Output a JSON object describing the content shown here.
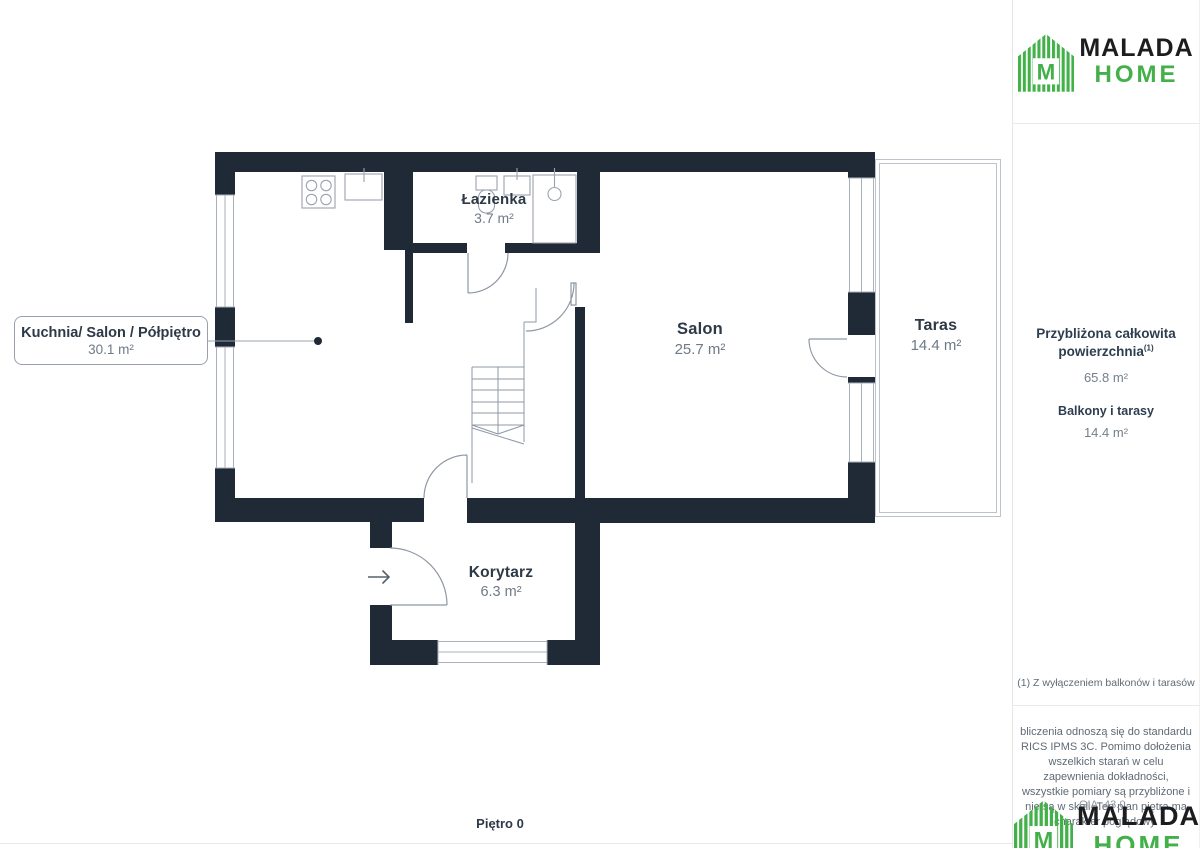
{
  "brand": {
    "primary": "MALADA",
    "secondary": "HOME"
  },
  "floor_plan": {
    "floor_label": "Piętro 0",
    "rooms": [
      {
        "id": "kuchnia-salon-polpietro",
        "name": "Kuchnia/ Salon / Półpiętro",
        "area": "30.1 m²"
      },
      {
        "id": "lazienka",
        "name": "Łazienka",
        "area": "3.7 m²"
      },
      {
        "id": "salon",
        "name": "Salon",
        "area": "25.7 m²"
      },
      {
        "id": "taras",
        "name": "Taras",
        "area": "14.4 m²"
      },
      {
        "id": "korytarz",
        "name": "Korytarz",
        "area": "6.3 m²"
      }
    ]
  },
  "sidebar": {
    "summary_title_line1": "Przybliżona całkowita",
    "summary_title_line2": "powierzchnia",
    "summary_title_sup": "(1)",
    "total_area": "65.8 m²",
    "balconies_label": "Balkony i tarasy",
    "balconies_area": "14.4 m²",
    "footnote": "(1) Z wyłączeniem balkonów i tarasów",
    "disclaimer": "bliczenia odnoszą się do standardu RICS IPMS 3C. Pomimo dołożenia wszelkich starań w celu zapewnienia dokładności, wszystkie pomiary są przybliżone i nie są w skali. Ten plan piętra ma charakter poglądowy.",
    "obscured_text": "GIA: 43.0"
  },
  "colors": {
    "wall": "#1f2a36",
    "accent_green": "#43b049",
    "label_dark": "#2d3947",
    "label_gray": "#6e7a87",
    "thin_line": "#9aa3ad"
  }
}
